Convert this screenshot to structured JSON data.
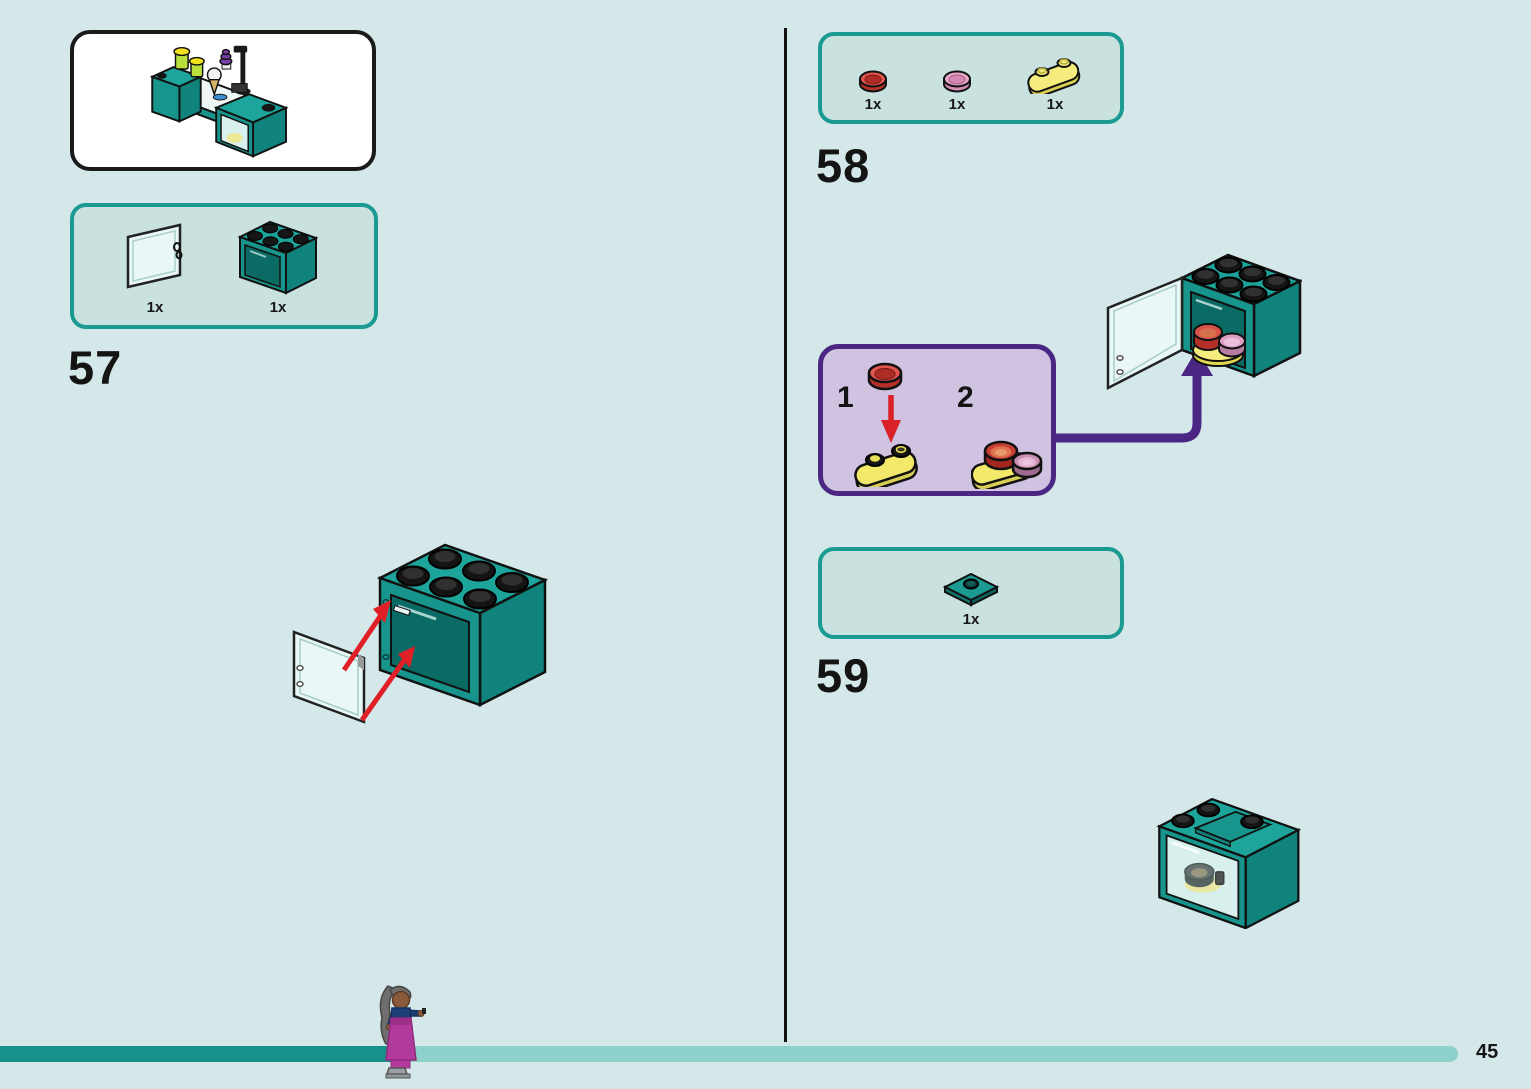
{
  "page": {
    "number": "45",
    "background_color": "#d5e8e9"
  },
  "progress_bar": {
    "done_color": "#16918c",
    "remaining_color": "#8ed1cb"
  },
  "preview": {
    "description": "ice-cream-counter-subassembly-preview"
  },
  "steps": {
    "s57": {
      "number": "57",
      "parts": [
        {
          "name": "transparent-cupboard-door-1x2x2",
          "count": "1x",
          "color": "#e9f8f6"
        },
        {
          "name": "dark-turquoise-cupboard-2x3x2",
          "count": "1x",
          "color": "#17958d"
        }
      ]
    },
    "s58": {
      "number": "58",
      "parts": [
        {
          "name": "red-round-tile-1x1",
          "count": "1x",
          "color": "#e0564e"
        },
        {
          "name": "pink-round-tile-1x1",
          "count": "1x",
          "color": "#eba9ca"
        },
        {
          "name": "yellow-rounded-plate-1x2",
          "count": "1x",
          "color": "#f4ec7c"
        }
      ],
      "substeps": [
        {
          "label": "1"
        },
        {
          "label": "2"
        }
      ],
      "callout": {
        "fill": "#cfc3e1",
        "border": "#4b2682"
      }
    },
    "s59": {
      "number": "59",
      "parts": [
        {
          "name": "dark-turquoise-plate-2x2-center-stud",
          "count": "1x",
          "color": "#1b9a92"
        }
      ]
    }
  }
}
